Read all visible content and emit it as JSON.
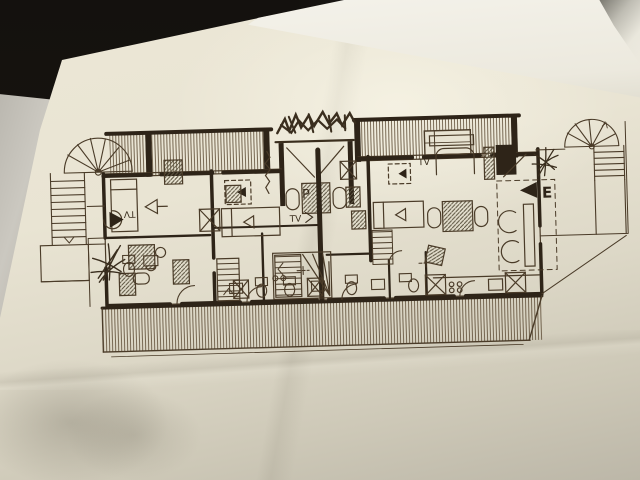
{
  "colors": {
    "bg": "#16130f",
    "paper": "#e8e3d2",
    "white_sheet": "#f2f0e7",
    "gray_sheet": "#c9c7c0",
    "ink": "#4a3b28",
    "wall": "#2e2418",
    "hatch": "#6a5844"
  },
  "plan": {
    "labels": {
      "tv_left": "TV",
      "tv_center": "TV",
      "tv_right": "TV",
      "p_mark": "P",
      "entrance_mark": "E"
    }
  }
}
